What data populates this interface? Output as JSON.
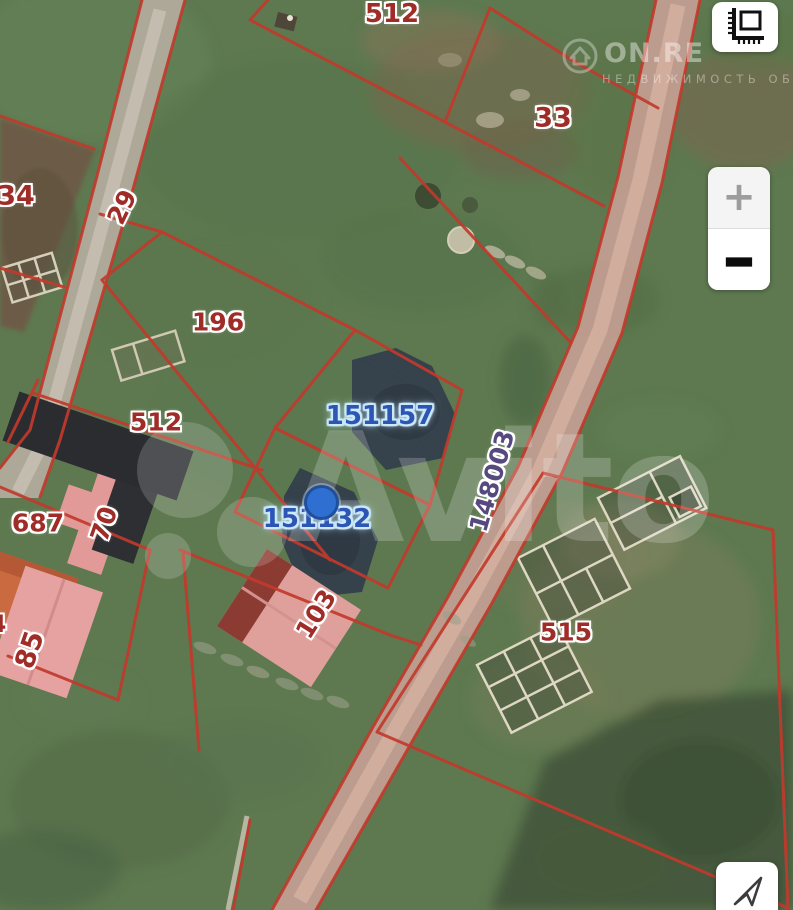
{
  "window": {
    "width": 793,
    "height": 910,
    "kind": "satellite-cadastral-map-screenshot"
  },
  "map": {
    "labels": [
      {
        "id": "parcel-512-top",
        "text": "512",
        "color": "red"
      },
      {
        "id": "parcel-33",
        "text": "33",
        "color": "red"
      },
      {
        "id": "parcel-34",
        "text": "34",
        "color": "red"
      },
      {
        "id": "road-29",
        "text": "29",
        "color": "red",
        "rotated": true
      },
      {
        "id": "parcel-196",
        "text": "196",
        "color": "red"
      },
      {
        "id": "parcel-512",
        "text": "512",
        "color": "red"
      },
      {
        "id": "parcel-687",
        "text": "687",
        "color": "red"
      },
      {
        "id": "building-70",
        "text": "70",
        "color": "red",
        "rotated": true
      },
      {
        "id": "building-85",
        "text": "85",
        "color": "red",
        "rotated": true
      },
      {
        "id": "building-103",
        "text": "103",
        "color": "red",
        "rotated": true
      },
      {
        "id": "parcel-515",
        "text": "515",
        "color": "red"
      },
      {
        "id": "road-148003",
        "text": "148003",
        "color": "purple",
        "rotated": true
      },
      {
        "id": "parcel-151157",
        "text": "151157",
        "color": "blue",
        "highlighted": true
      },
      {
        "id": "parcel-151132",
        "text": "151132",
        "color": "blue",
        "highlighted": true
      },
      {
        "id": "parcel-4-partial",
        "text": "4",
        "color": "red",
        "clipped": true
      }
    ],
    "selected_parcel_ids": [
      "151157",
      "151132"
    ],
    "marker": {
      "shape": "circle",
      "color": "#2f6fd2"
    }
  },
  "controls": {
    "measure_button": {
      "icon": "ruler-icon"
    },
    "zoom_in_label": "+",
    "zoom_out_label": "−",
    "locate_button": {
      "icon": "navigation-arrow-icon"
    }
  },
  "watermarks": {
    "brand": "Avito",
    "site_logo_text": "ON.RE",
    "site_logo_icon": "house-icon",
    "site_tagline": "НЕДВИЖИМОСТЬ ОБЛ"
  },
  "colors": {
    "boundary_red": "#c23a2c",
    "label_red": "#a02c28",
    "label_blue": "#2d55b4",
    "label_purple": "#55497e",
    "marker_blue": "#2f6fd2",
    "pond_navy": "#343f4b",
    "road_left": "#b2ab9d",
    "road_right": "#c6a095",
    "grass_base": "#5e7950"
  }
}
